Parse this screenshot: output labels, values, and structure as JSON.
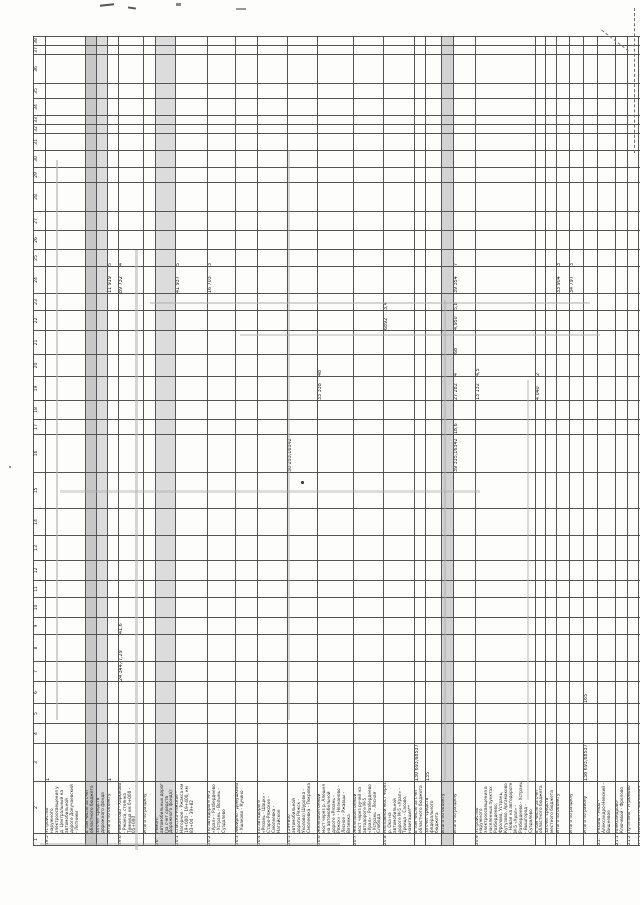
{
  "document": {
    "kind": "scanned rotated table page",
    "language": "ru"
  },
  "table": {
    "columns": [
      {
        "n": "1",
        "w": 12
      },
      {
        "n": "2",
        "w": 52
      },
      {
        "n": "3",
        "w": 38
      },
      {
        "n": "4",
        "w": 20
      },
      {
        "n": "5",
        "w": 20
      },
      {
        "n": "6",
        "w": 22
      },
      {
        "n": "7",
        "w": 20
      },
      {
        "n": "8",
        "w": 27
      },
      {
        "n": "9",
        "w": 17
      },
      {
        "n": "10",
        "w": 20
      },
      {
        "n": "11",
        "w": 17
      },
      {
        "n": "12",
        "w": 20
      },
      {
        "n": "13",
        "w": 25
      },
      {
        "n": "14",
        "w": 27
      },
      {
        "n": "15",
        "w": 36
      },
      {
        "n": "16",
        "w": 38
      },
      {
        "n": "17",
        "w": 15
      },
      {
        "n": "18",
        "w": 19
      },
      {
        "n": "19",
        "w": 24
      },
      {
        "n": "20",
        "w": 22
      },
      {
        "n": "21",
        "w": 24
      },
      {
        "n": "22",
        "w": 20
      },
      {
        "n": "23",
        "w": 17
      },
      {
        "n": "24",
        "w": 27
      },
      {
        "n": "25",
        "w": 17
      },
      {
        "n": "26",
        "w": 19
      },
      {
        "n": "27",
        "w": 19
      },
      {
        "n": "28",
        "w": 29
      },
      {
        "n": "29",
        "w": 15
      },
      {
        "n": "30",
        "w": 17
      },
      {
        "n": "31",
        "w": 17
      },
      {
        "n": "32",
        "w": 9
      },
      {
        "n": "33",
        "w": 9
      },
      {
        "n": "34",
        "w": 17
      },
      {
        "n": "35",
        "w": 15
      },
      {
        "n": "36",
        "w": 29
      },
      {
        "n": "37",
        "w": 9
      },
      {
        "n": "38",
        "w": 9
      }
    ],
    "rows": [
      {
        "num": "19.5",
        "h": 40,
        "shade": "",
        "desc": "Устройство наружного электроосвещения у д. Центральный на автомобильной дороге Докучаевский - Летники",
        "cells": {
          "3": "1"
        }
      },
      {
        "num": "",
        "h": 9,
        "shade": "shade1",
        "desc": "в том числе за счет областного бюджета",
        "cells": {}
      },
      {
        "num": "",
        "h": 9,
        "shade": "shade2",
        "desc": "за счет средств дорожного фонда",
        "cells": {}
      },
      {
        "num": "",
        "h": 11,
        "shade": "",
        "desc": "Итого по объекту",
        "cells": {
          "3": "1",
          "24": "11 919",
          "25": "5"
        }
      },
      {
        "num": "19.6",
        "h": 25,
        "shade": "",
        "desc": "Ремонтово - Харюково - Ржакса, стоянка Темница км 0+000 - 05+000",
        "cells": {
          "7": "24 344,42058",
          "8": "7,29",
          "9": "41,6",
          "24": "89 732",
          "25": "4"
        }
      },
      {
        "num": "",
        "h": 12,
        "shade": "",
        "desc": "Итого по разделу",
        "cells": {}
      },
      {
        "num": "20.",
        "h": 16,
        "shade": "shade2",
        "desc": "Ремонт автомобильных дорог (за счет средств Дорожного фонда):",
        "cells": {}
      },
      {
        "num": "20.1",
        "h": 32,
        "shade": "",
        "desc": "Спасско-Ряжское - Нагорное - Ржакса км 19+000 - 19+400, км 83+04 - 39+82",
        "cells": {
          "24": "41 937",
          "25": "5"
        }
      },
      {
        "num": "20.2",
        "h": 28,
        "shade": "",
        "desc": "По автодороге М-5 «Урал» - Разбердеево - Устрань - Волынь - Суздалево",
        "cells": {
          "24": "16 703",
          "25": "3"
        }
      },
      {
        "num": "20.3",
        "h": 22,
        "shade": "",
        "desc": "Ямбирно - Демушкино - Ушаково - Кучино",
        "cells": {}
      },
      {
        "num": "20.4",
        "h": 30,
        "shade": "",
        "desc": "По автодороге «Рязань - Шацк» - Старо-Ряжское - Смолеевка - Нагайское",
        "cells": {}
      },
      {
        "num": "20.5",
        "h": 30,
        "shade": "",
        "desc": "(19+800 автомобильной дороги Ряжск - Ухолово) Шуровка - Смолеевка - Покровка",
        "cells": {
          "16": "30 253,16342"
        }
      },
      {
        "num": "20.6",
        "h": 32,
        "shade": "",
        "desc": "Железобетонный мост через р. Алешня на автомобильной дороге «Рязань - Ряжск» - Незнаново - Лесное - Ржавцы - Вяземка",
        "cells": {
          "19": "33 338",
          "20": "48"
        }
      },
      {
        "num": "20.7",
        "h": 17,
        "shade": "",
        "desc": "Железобетонный мост через ручей на автодороге М-5 «Урал» - Разбердеево - Устрань - Лесная Слобода",
        "cells": {}
      },
      {
        "num": "20.8",
        "h": 30,
        "shade": "",
        "desc": "Наплавной мост через р. Ока на автомобильной дороге М-5 «Урал» - Троица - Сасово, навигация**",
        "cells": {
          "22": "6892",
          "23": "3,4"
        }
      },
      {
        "num": "",
        "h": 10,
        "shade": "",
        "desc": "в том числе за счет областного бюджета",
        "cells": {
          "3": "130 693,68537"
        }
      },
      {
        "num": "",
        "h": 10,
        "shade": "",
        "desc": "за счет средств федерального бюджета",
        "cells": {
          "3": "135"
        }
      },
      {
        "num": "",
        "h": 12,
        "shade": "shade3",
        "desc": "Итого по объекту",
        "cells": {}
      },
      {
        "num": "",
        "h": 22,
        "shade": "",
        "desc": "Итого по разделу",
        "cells": {
          "16": "39 335,16342",
          "17": "18,6",
          "19": "27 282",
          "20": "4",
          "21": "68",
          "22": "4,950",
          "23": "5,8",
          "24": "39 354",
          "25": "7"
        }
      },
      {
        "num": "20.9",
        "h": 55,
        "shade": "",
        "desc": "Устройство наружного электроосвещения в населенных пунктах Разбердеево, Фролово, Устрань, Кутузово, Аргамаково - Новая на автодороге М-5 «Урал» - Разбердеево - Устрань - Вышгород - Суздалево",
        "cells": {
          "19": "13 132",
          "20": "4,5"
        }
      },
      {
        "num": "",
        "h": 10,
        "shade": "",
        "desc": "в том числе за счет областного бюджета",
        "cells": {
          "19": "4 040",
          "20": "2"
        }
      },
      {
        "num": "",
        "h": 10,
        "shade": "",
        "desc": "за счет средств местного бюджета",
        "cells": {}
      },
      {
        "num": "",
        "h": 13,
        "shade": "",
        "desc": "Итого по объекту",
        "cells": {
          "24": "33 904",
          "25": "3"
        }
      },
      {
        "num": "",
        "h": 14,
        "shade": "",
        "desc": "Итого по разделу",
        "cells": {
          "24": "34 797",
          "25": "3"
        }
      },
      {
        "num": "",
        "h": 14,
        "shade": "",
        "desc": "Итого по району",
        "cells": {
          "3": "138 693,68537",
          "6": "165"
        }
      },
      {
        "num": "21.",
        "h": 18,
        "shade": "",
        "desc": "Рязань - Рясы - Александро-Невский - Вишневое",
        "cells": {}
      },
      {
        "num": "21.1",
        "h": 12,
        "shade": "",
        "desc": "Александрово-Ключевой - Фролово",
        "cells": {}
      },
      {
        "num": "21.2",
        "h": 11,
        "shade": "",
        "desc": "Путятино - Угрюмово",
        "cells": {}
      },
      {
        "num": "21.3",
        "h": 11,
        "shade": "",
        "desc": "Ухолово - Смирновка",
        "cells": {}
      }
    ]
  }
}
